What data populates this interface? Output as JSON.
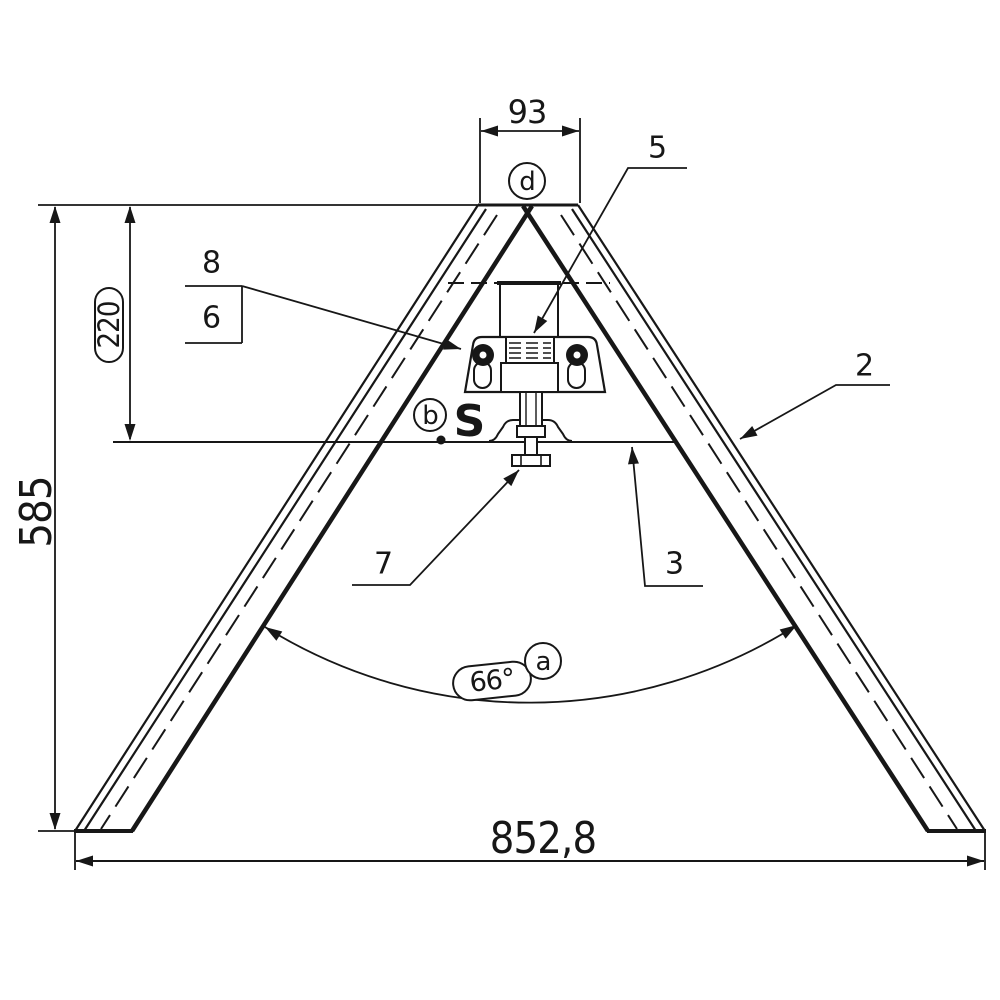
{
  "drawing": {
    "ink": "#171717",
    "background": "#ffffff",
    "dimensions": {
      "top_width": "93",
      "overall_height": "585",
      "bracket_height": "220",
      "base_width": "852,8",
      "leg_angle": "66°"
    },
    "part_labels": {
      "p2": "2",
      "p3": "3",
      "p5": "5",
      "p6": "6",
      "p7": "7",
      "p8": "8"
    },
    "reference_balloons": {
      "a": "a",
      "b": "b",
      "d": "d"
    },
    "logo": "S"
  }
}
